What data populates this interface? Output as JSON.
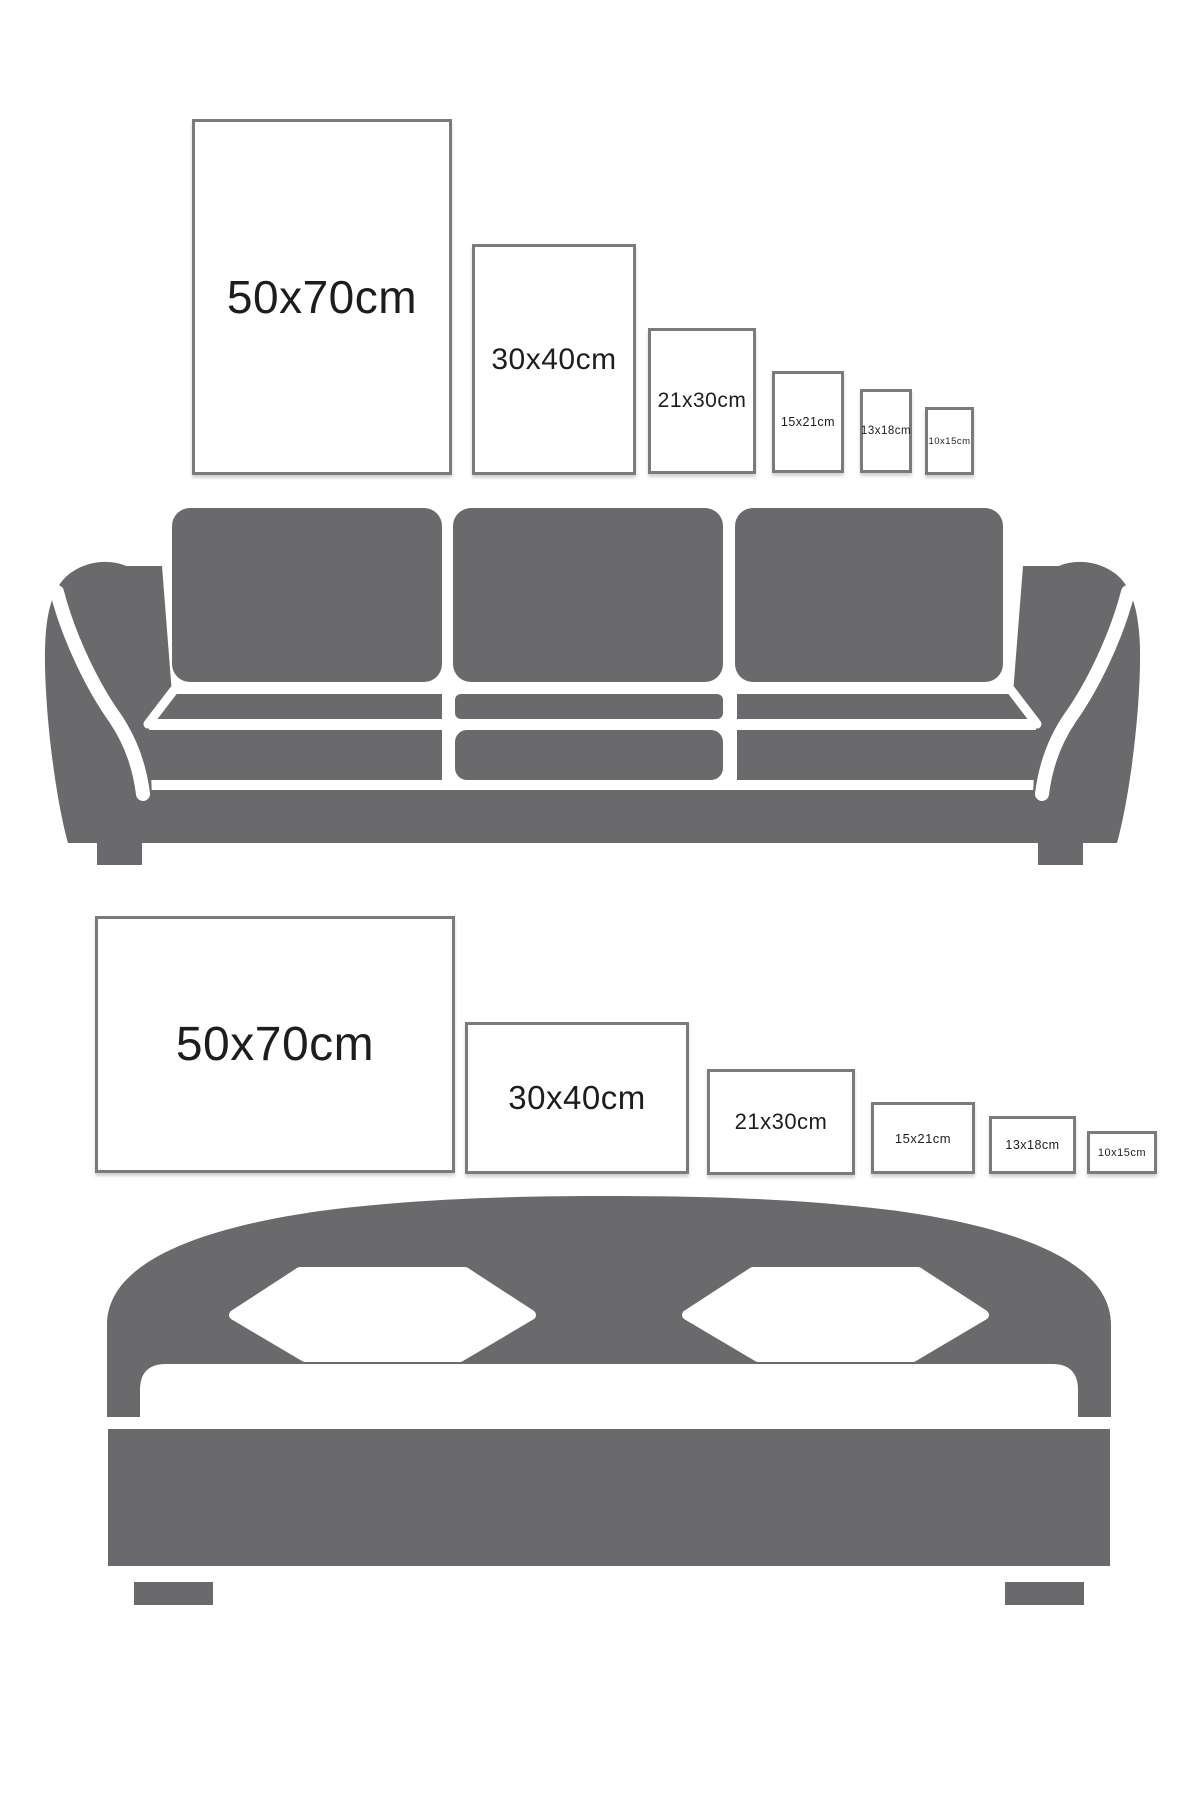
{
  "title": "poster-size-guide",
  "colors": {
    "furniture_gray": "#6a6a6c",
    "frame_border_gray": "#7b7b7d",
    "label_text": "#1d1d1f",
    "background": "#ffffff"
  },
  "poster_rows": [
    {
      "name": "portrait-frames-above-sofa",
      "orientation": "portrait",
      "frames": [
        {
          "label": "50x70cm"
        },
        {
          "label": "30x40cm"
        },
        {
          "label": "21x30cm"
        },
        {
          "label": "15x21cm"
        },
        {
          "label": "13x18cm"
        },
        {
          "label": "10x15cm"
        }
      ]
    },
    {
      "name": "landscape-frames-above-bed",
      "orientation": "landscape",
      "frames": [
        {
          "label": "50x70cm"
        },
        {
          "label": "30x40cm"
        },
        {
          "label": "21x30cm"
        },
        {
          "label": "15x21cm"
        },
        {
          "label": "13x18cm"
        },
        {
          "label": "10x15cm"
        }
      ]
    }
  ],
  "furniture": [
    {
      "name": "sofa"
    },
    {
      "name": "bed"
    }
  ]
}
